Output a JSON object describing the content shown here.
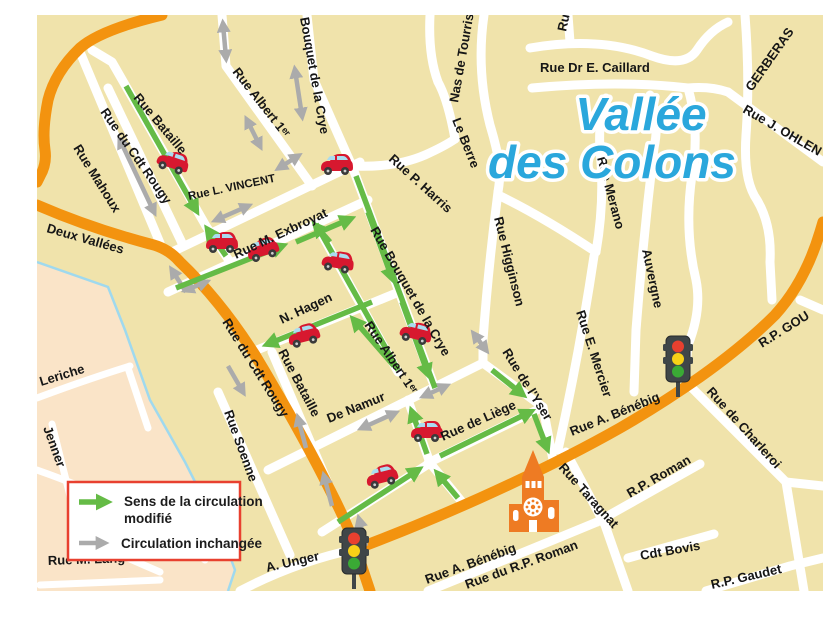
{
  "map": {
    "title": {
      "line1": "Vallée",
      "line2": "des Colons"
    },
    "legend": {
      "modified_line1": "Sens de la circulation",
      "modified_line2": "modifié",
      "unchanged": "Circulation inchangée"
    },
    "streets": {
      "bataille_upper": "Rue Bataille",
      "cdt_rougy_white": "Rue du Cdt Rougy",
      "mahoux": "Rue Mahoux",
      "deux_vallees": "Deux Vallées",
      "cdt_rougy_orange": "Rue du Cdt Rougy",
      "albert_1er_upper": "Rue Albert 1ᵉʳ",
      "bouquet_crye_upper": "Bouquet de la Crye",
      "l_vincent": "Rue L. VINCENT",
      "m_exbroyat": "Rue M. Exbroyat",
      "n_hagen": "N. Hagen",
      "bouquet_crye_center": "Rue Bouquet de la Crye",
      "albert_1er_center": "Rue Albert 1ᵉʳ",
      "de_namur": "De Namur",
      "de_liege": "Rue de Liège",
      "de_lyser": "Rue de l'Yser",
      "bataille_lower": "Rue Bataille",
      "soenne": "Rue Soenne",
      "a_unger": "A. Unger",
      "benebig_lower": "Rue A. Bénébig",
      "benebig_upper": "Rue A. Bénébig",
      "du_rp_roman": "Rue du R.P. Roman",
      "taragnat": "Rue Taragnat",
      "rp_roman": "R.P. Roman",
      "cdt_bovis": "Cdt Bovis",
      "rp_gaudet": "R.P. Gaudet",
      "charleroi": "Rue de Charleroi",
      "rp_gou": "R.P. GOU",
      "e_mercier": "Rue E. Mercier",
      "merano": "Rue Merano",
      "auvergne": "Auvergne",
      "higginson": "Rue Higginson",
      "p_harris": "Rue P. Harris",
      "le_berre": "Le Berre",
      "nas_de_tourris": "Nas de Tourris",
      "dr_caillard": "Rue Dr E. Caillard",
      "gerberas": "GERBERAS",
      "j_ohlen": "Rue J. OHLEN",
      "rue_partial_top": "Rue",
      "leriche": "F. Leriche",
      "jenner": "Jenner",
      "m_lang": "Rue M. Lang"
    },
    "icons": {
      "car": "red-car",
      "traffic_light": "traffic-light",
      "church": "church-clock-tower",
      "car_count": 9,
      "traffic_light_count": 2,
      "church_count": 1
    },
    "colors": {
      "map-bg": "#f0e3ab",
      "district-bg": "#fae4c8",
      "road-major": "#f3930f",
      "road-minor": "#ffffff",
      "arrow-modified": "#65bb46",
      "arrow-unchanged": "#ababab",
      "title-blue": "#2aa7dc",
      "legend-border": "#e8402f",
      "boundary-blue": "#9fd9ee",
      "car-red": "#d7182f",
      "church-orange": "#ee7b23"
    }
  }
}
